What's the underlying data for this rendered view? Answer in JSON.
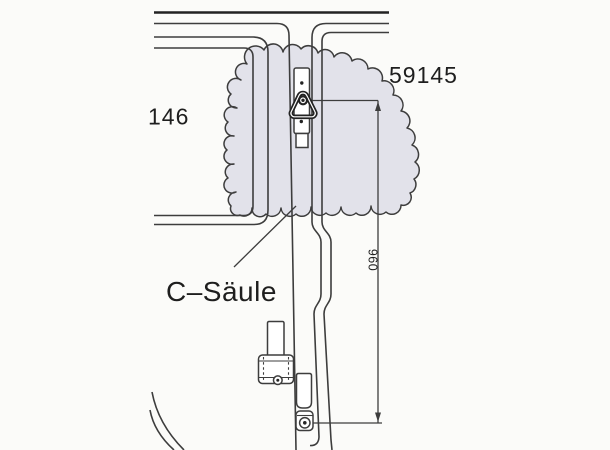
{
  "labels": {
    "part_number_right": "59145",
    "part_number_left": "146",
    "pillar_callout": "C–Säule",
    "dimension_value": "960"
  },
  "colors": {
    "background": "#fbfbf9",
    "line": "#3d3d3d",
    "line_dark": "#232323",
    "highlight_fill": "#e2e2ea",
    "text": "#1e1e1e"
  }
}
